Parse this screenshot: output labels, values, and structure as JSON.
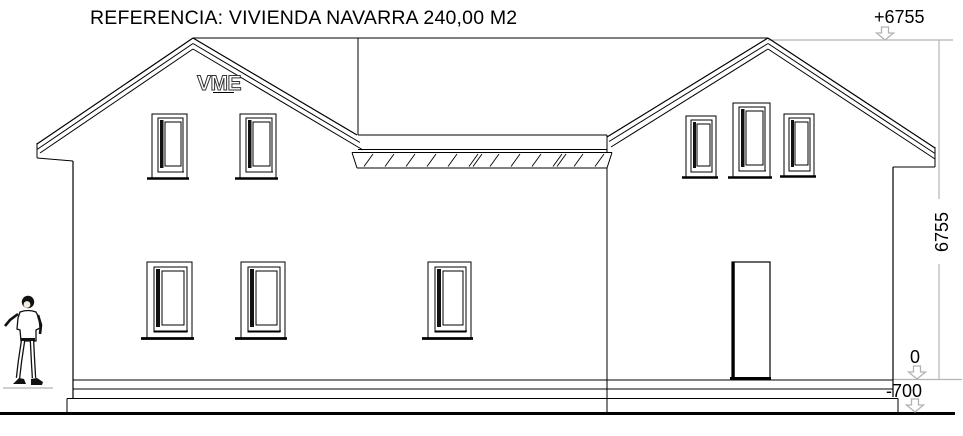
{
  "title": "REFERENCIA: VIVIENDA NAVARRA 240,00 M2",
  "logo_text": "VME",
  "annotations": {
    "ridge_level": "+6755",
    "ground_level": "0",
    "foundation_level": "-700",
    "height_dimension": "6755"
  },
  "colors": {
    "line": "#000000",
    "annotation_gray": "#b3b3b3",
    "background": "#ffffff"
  }
}
